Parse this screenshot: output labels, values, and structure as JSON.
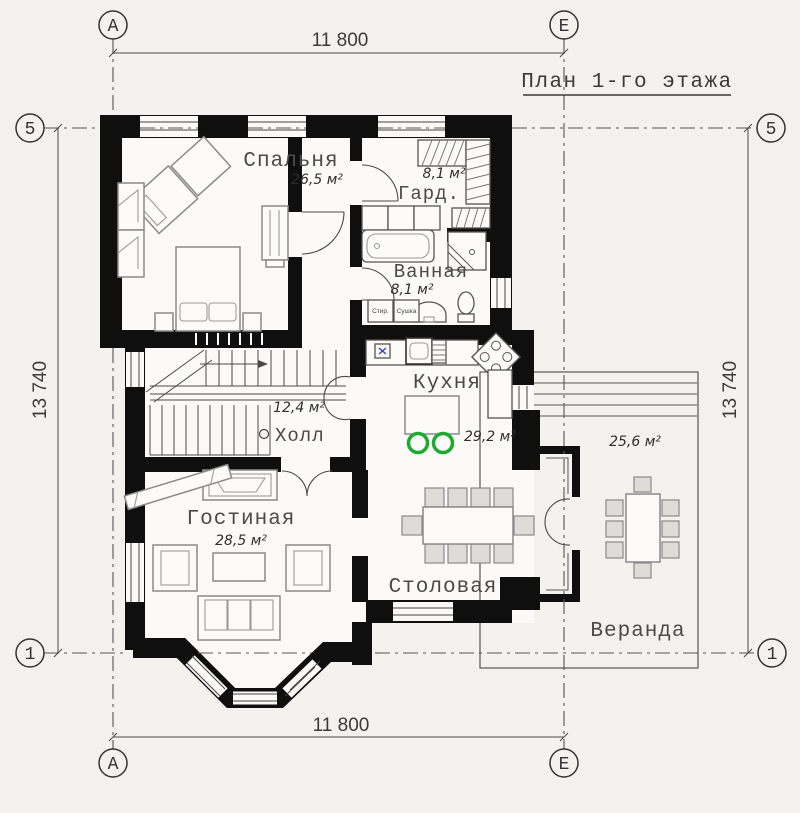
{
  "title": "План 1-го этажа",
  "axis_labels": {
    "a": "А",
    "e": "Е",
    "five": "5",
    "one": "1"
  },
  "dimensions": {
    "top": "11 800",
    "bottom": "11 800",
    "left": "13 740",
    "right": "13 740"
  },
  "rooms": {
    "bedroom": {
      "name": "Спальня",
      "area": "26,5 м²"
    },
    "wardrobe": {
      "name": "Гард.",
      "area": "8,1 м²"
    },
    "bathroom": {
      "name": "Ванная",
      "area": "8,1 м²"
    },
    "kitchen": {
      "name": "Кухня",
      "area": "29,2 м²"
    },
    "hall": {
      "name": "Холл",
      "area": "12,4 м²"
    },
    "living": {
      "name": "Гостиная",
      "area": "28,5 м²"
    },
    "dining": {
      "name": "Столовая"
    },
    "veranda": {
      "name": "Веранда",
      "area": "25,6 м²"
    }
  },
  "appliances": {
    "washer": "Стир.",
    "dryer": "Сушка"
  },
  "colors": {
    "wall": "#0f0f0f",
    "stool_green": "#1ea92f",
    "marker_blue": "#3846c8",
    "background": "#f3f2ef"
  }
}
